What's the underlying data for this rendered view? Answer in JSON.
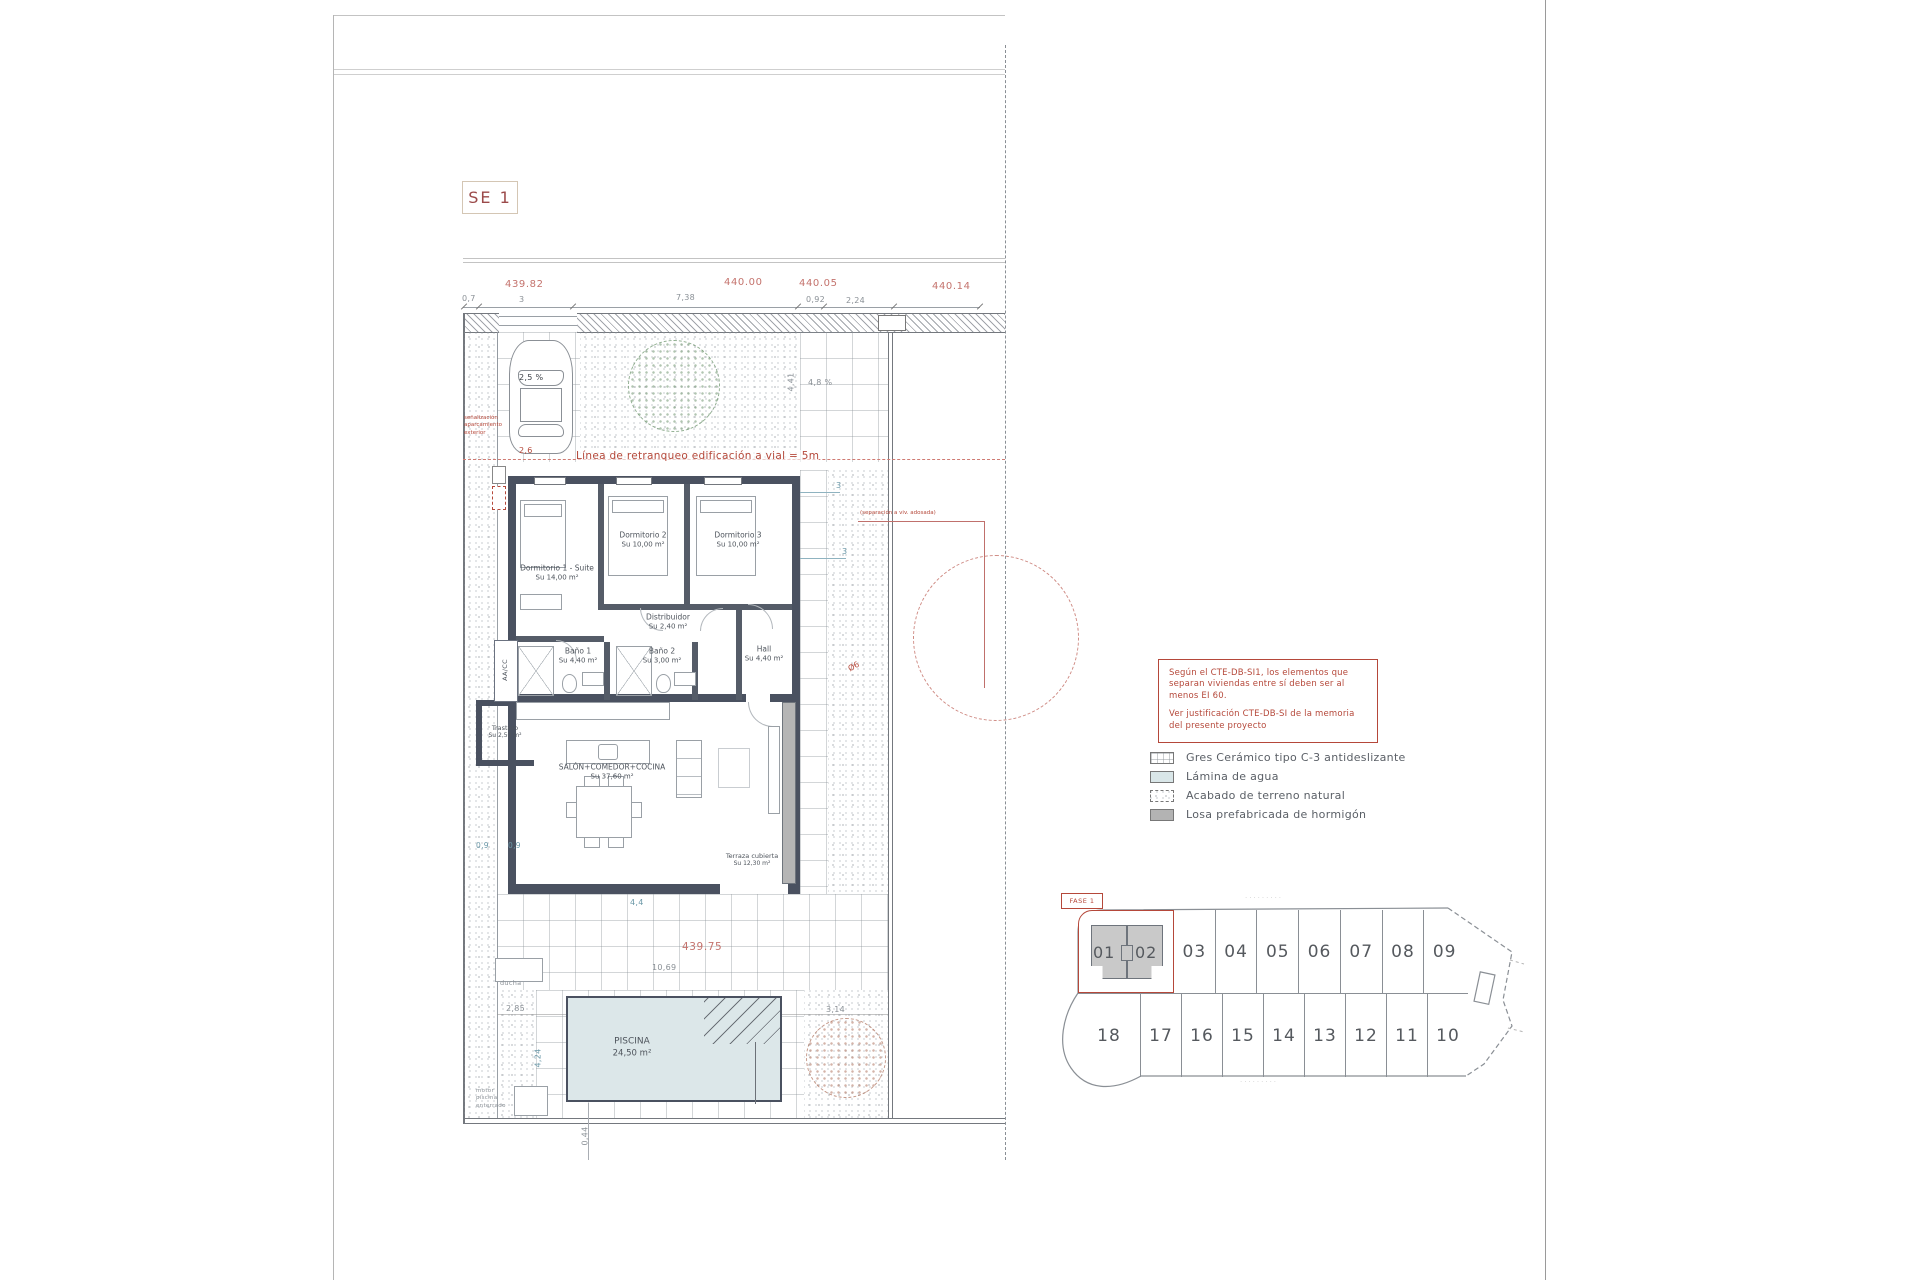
{
  "sheet": {
    "se_label": "SE 1"
  },
  "levels": {
    "top1": "439.82",
    "top2": "440.00",
    "top3": "440.05",
    "top4": "440.14",
    "court": "439.75"
  },
  "dims": {
    "top": {
      "d07": "0,7",
      "d3": "3",
      "d738": "7,38",
      "d092": "0,92",
      "d224": "2,24"
    },
    "side": {
      "d3a": "3",
      "d3b": "3",
      "circle": "Ø6",
      "d441": "4,41",
      "slope_patio": "4,8 %"
    },
    "car": {
      "slope": "2,5 %",
      "width": "2,6"
    },
    "court": {
      "d44": "4,4",
      "d1069": "10,69",
      "d09a": "0,9",
      "d09b": "0,9"
    },
    "pool": {
      "d285": "2,85",
      "d7": "7",
      "d314": "3,14",
      "d35": "3,5",
      "d424": "4,24",
      "d044": "0,44"
    }
  },
  "notes": {
    "setback": "Línea de retranqueo edificación a vial = 5m",
    "parking_sign": "señalización aparcamiento exterior",
    "separation": "(separación a viv. adosada)",
    "ducha": "ducha",
    "motor": "motor piscina enterrado",
    "aacc": "AA/CC"
  },
  "rooms": {
    "d1": {
      "name": "Dormitorio 1 - Suite",
      "area": "Su 14,00 m²"
    },
    "d2": {
      "name": "Dormitorio 2",
      "area": "Su 10,00 m²"
    },
    "d3": {
      "name": "Dormitorio 3",
      "area": "Su 10,00 m²"
    },
    "dist": {
      "name": "Distribuidor",
      "area": "Su 2,40 m²"
    },
    "b1": {
      "name": "Baño 1",
      "area": "Su 4,40 m²"
    },
    "b2": {
      "name": "Baño 2",
      "area": "Su 3,00 m²"
    },
    "hall": {
      "name": "Hall",
      "area": "Su 4,40 m²"
    },
    "trastero": {
      "name": "Trastero",
      "area": "Su 2,50 m²"
    },
    "salon": {
      "name": "SALÓN+COMEDOR+COCINA",
      "area": "Su 37,60 m²"
    },
    "terraza": {
      "name": "Terraza cubierta",
      "area": "Su 12,30 m²"
    },
    "piscina": {
      "name": "PISCINA",
      "area": "24,50 m²"
    }
  },
  "fire_note": {
    "p1": "Según el CTE-DB-SI1, los elementos que separan viviendas entre sí deben ser al menos EI 60.",
    "p2": "Ver justificación CTE-DB-SI de la memoria del presente proyecto"
  },
  "legend": {
    "items": [
      {
        "key": "gres",
        "label": "Gres Cerámico tipo C-3 antideslizante"
      },
      {
        "key": "lamina",
        "label": "Lámina de agua"
      },
      {
        "key": "terreno",
        "label": "Acabado de terreno natural"
      },
      {
        "key": "losa",
        "label": "Losa prefabricada de hormigón"
      }
    ]
  },
  "site_plan": {
    "fase": "FASE 1",
    "top_row": [
      "01",
      "02",
      "03",
      "04",
      "05",
      "06",
      "07",
      "08",
      "09"
    ],
    "bottom_row": [
      "18",
      "17",
      "16",
      "15",
      "14",
      "13",
      "12",
      "11",
      "10"
    ],
    "street_top": "·········",
    "street_bottom": "·········"
  },
  "colors": {
    "accent_red": "#b5483a",
    "level_red": "#c4736d",
    "wall_dark": "#4a5160",
    "water": "#dce7e9",
    "losa_gray": "#b5b5b5",
    "dim_gray": "#8a9096",
    "dim_teal": "#6b98a8"
  }
}
